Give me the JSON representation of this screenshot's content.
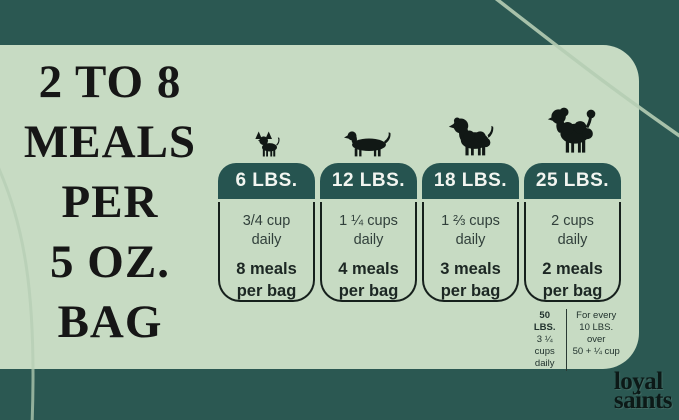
{
  "title_lines": [
    "2 TO 8",
    "MEALS",
    "PER",
    "5 OZ.",
    "BAG"
  ],
  "columns": [
    {
      "weight": "6 LBS.",
      "daily1": "3/4 cup",
      "daily2": "daily",
      "meals1": "8 meals",
      "meals2": "per bag",
      "dog": "chihuahua"
    },
    {
      "weight": "12 LBS.",
      "daily1": "1 ¼ cups",
      "daily2": "daily",
      "meals1": "4 meals",
      "meals2": "per bag",
      "dog": "dachshund"
    },
    {
      "weight": "18 LBS.",
      "daily1": "1 ⅔ cups",
      "daily2": "daily",
      "meals1": "3 meals",
      "meals2": "per bag",
      "dog": "spaniel-puppy"
    },
    {
      "weight": "25 LBS.",
      "daily1": "2 cups",
      "daily2": "daily",
      "meals1": "2 meals",
      "meals2": "per bag",
      "dog": "poodle"
    }
  ],
  "footnote": {
    "left": {
      "line1": "50 LBS.",
      "line2": "3 ¼ cups",
      "line3": "daily"
    },
    "right": {
      "line1": "For every",
      "line2": "10 LBS. over",
      "line3": "50 + ¼ cup"
    }
  },
  "logo": {
    "line1": "loyal",
    "line2": "saints"
  },
  "colors": {
    "background": "#2b5852",
    "panel": "#c7dbc3",
    "card_header": "#265450",
    "card_border": "#16201c",
    "decor_line": "#b5cdb4",
    "title_text": "#161616",
    "header_text": "#f2f5f0"
  }
}
